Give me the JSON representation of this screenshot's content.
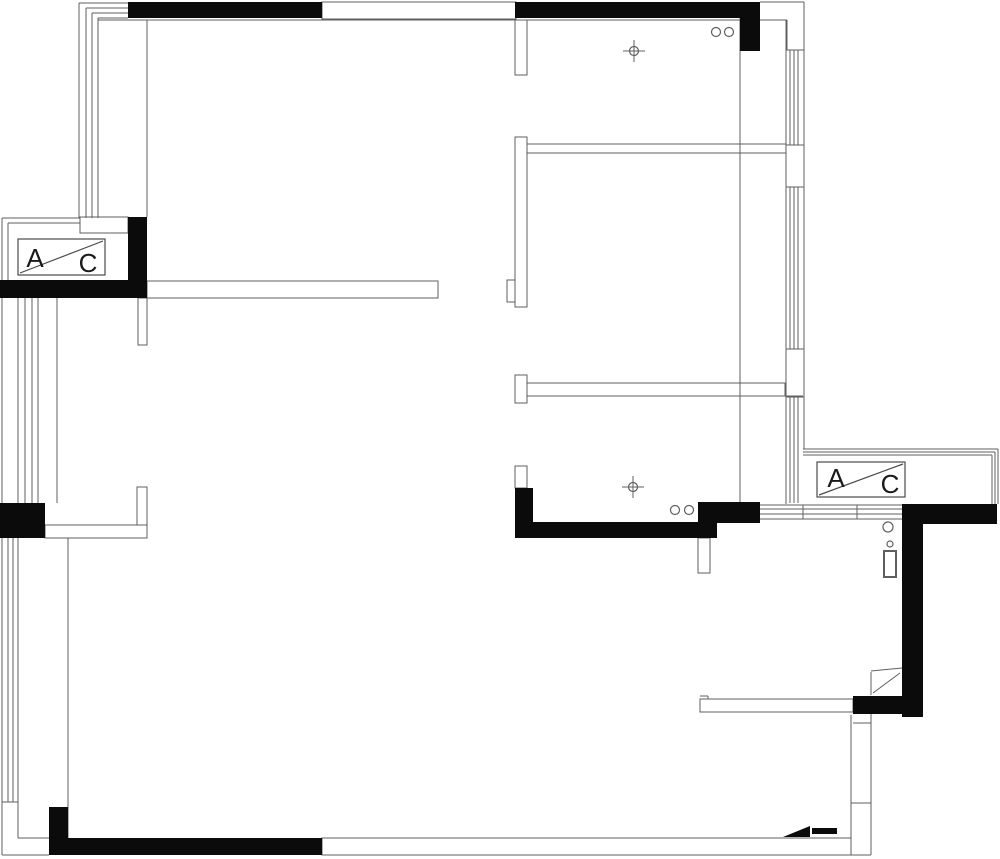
{
  "canvas": {
    "width": 1000,
    "height": 859,
    "background": "#ffffff",
    "line_color": "#5f5f5f",
    "wall_fill": "#0b0b0b",
    "text_color": "#1a1a1a"
  },
  "ac_labels": {
    "left": {
      "a": "A",
      "c": "C"
    },
    "right": {
      "a": "A",
      "c": "C"
    }
  },
  "plan": {
    "outline_rects": [
      {
        "n": "top-window-band",
        "x": 322,
        "y": 2,
        "w": 194,
        "h": 17
      },
      {
        "n": "wall-topleft-room-bottom",
        "x": 147,
        "y": 281,
        "w": 291,
        "h": 17
      },
      {
        "n": "wall-stub-below-topleft-room",
        "x": 138,
        "y": 298,
        "w": 9,
        "h": 47
      },
      {
        "n": "left-step-under-window",
        "x": 80,
        "y": 217,
        "w": 48,
        "h": 16
      },
      {
        "n": "wall-stub-middle-top",
        "x": 515,
        "y": 20,
        "w": 12,
        "h": 55
      },
      {
        "n": "wall-middle-vertical",
        "x": 515,
        "y": 137,
        "w": 12,
        "h": 170
      },
      {
        "n": "wall-notch-middle",
        "x": 507,
        "y": 280,
        "w": 8,
        "h": 22
      },
      {
        "n": "wall-middle-tee-stub",
        "x": 515,
        "y": 375,
        "w": 12,
        "h": 28
      },
      {
        "n": "wall-band-midroom-bottom",
        "x": 527,
        "y": 383,
        "w": 258,
        "h": 13
      },
      {
        "n": "wall-stub-above-kitchen-column",
        "x": 515,
        "y": 466,
        "w": 12,
        "h": 22
      },
      {
        "n": "wall-band-topright-room-bottom",
        "x": 527,
        "y": 144,
        "w": 259,
        "h": 9
      },
      {
        "n": "wall-stub-below-kitchen-bar",
        "x": 698,
        "y": 538,
        "w": 12,
        "h": 35
      },
      {
        "n": "hallway-wall",
        "x": 700,
        "y": 699,
        "w": 153,
        "h": 13
      },
      {
        "n": "bottom-wall-white",
        "x": 322,
        "y": 838,
        "w": 529,
        "h": 17
      },
      {
        "n": "left-ell-wall-vertical",
        "x": 137,
        "y": 487,
        "w": 10,
        "h": 38
      },
      {
        "n": "left-ell-wall-horizontal",
        "x": 45,
        "y": 525,
        "w": 102,
        "h": 13
      },
      {
        "n": "water-heater-body",
        "x": 884,
        "y": 551,
        "w": 12,
        "h": 26,
        "sw": 2
      }
    ],
    "lines": [
      {
        "n": "corner-nest-h1",
        "x1": 79,
        "y1": 3,
        "x2": 128,
        "y2": 3
      },
      {
        "n": "corner-nest-h2",
        "x1": 86,
        "y1": 8,
        "x2": 128,
        "y2": 8
      },
      {
        "n": "corner-nest-h3",
        "x1": 92,
        "y1": 13,
        "x2": 128,
        "y2": 13
      },
      {
        "n": "corner-nest-h4",
        "x1": 98,
        "y1": 18,
        "x2": 128,
        "y2": 18
      },
      {
        "n": "left-window-v1",
        "x1": 79,
        "y1": 3,
        "x2": 79,
        "y2": 218
      },
      {
        "n": "left-window-v2",
        "x1": 86,
        "y1": 8,
        "x2": 86,
        "y2": 218
      },
      {
        "n": "left-window-v3",
        "x1": 92,
        "y1": 13,
        "x2": 92,
        "y2": 218
      },
      {
        "n": "left-window-v4",
        "x1": 98,
        "y1": 18,
        "x2": 98,
        "y2": 218
      },
      {
        "n": "topleft-room-inner-top",
        "x1": 98,
        "y1": 20,
        "x2": 515,
        "y2": 20
      },
      {
        "n": "topleft-room-left-wall",
        "x1": 147,
        "y1": 20,
        "x2": 147,
        "y2": 217
      },
      {
        "n": "topright-room-inner-top",
        "x1": 527,
        "y1": 20,
        "x2": 740,
        "y2": 20
      },
      {
        "n": "topright-outer-top",
        "x1": 760,
        "y1": 2,
        "x2": 804,
        "y2": 2
      },
      {
        "n": "right-outer-edge",
        "x1": 804,
        "y1": 2,
        "x2": 804,
        "y2": 449
      },
      {
        "n": "topright-inner-ledge",
        "x1": 760,
        "y1": 20,
        "x2": 787,
        "y2": 20
      },
      {
        "n": "topright-inner-ledge-v",
        "x1": 787,
        "y1": 20,
        "x2": 787,
        "y2": 50
      },
      {
        "n": "right-wall-inner-edge",
        "x1": 786,
        "y1": 20,
        "x2": 786,
        "y2": 504
      },
      {
        "n": "right-window1-p1",
        "x1": 790,
        "y1": 50,
        "x2": 790,
        "y2": 145
      },
      {
        "n": "right-window1-p2",
        "x1": 794,
        "y1": 50,
        "x2": 794,
        "y2": 145
      },
      {
        "n": "right-window1-p3",
        "x1": 798,
        "y1": 50,
        "x2": 798,
        "y2": 145
      },
      {
        "n": "right-window1-top-tick",
        "x1": 786,
        "y1": 50,
        "x2": 804,
        "y2": 50
      },
      {
        "n": "right-window1-bottom-tick",
        "x1": 786,
        "y1": 145,
        "x2": 804,
        "y2": 145
      },
      {
        "n": "right-window2-p1",
        "x1": 790,
        "y1": 187,
        "x2": 790,
        "y2": 349
      },
      {
        "n": "right-window2-p2",
        "x1": 794,
        "y1": 187,
        "x2": 794,
        "y2": 349
      },
      {
        "n": "right-window2-p3",
        "x1": 798,
        "y1": 187,
        "x2": 798,
        "y2": 349
      },
      {
        "n": "right-window2-top-tick",
        "x1": 786,
        "y1": 187,
        "x2": 804,
        "y2": 187
      },
      {
        "n": "right-window2-bottom-tick",
        "x1": 786,
        "y1": 349,
        "x2": 804,
        "y2": 349
      },
      {
        "n": "right-window3-p1",
        "x1": 790,
        "y1": 397,
        "x2": 790,
        "y2": 503
      },
      {
        "n": "right-window3-p2",
        "x1": 794,
        "y1": 397,
        "x2": 794,
        "y2": 503
      },
      {
        "n": "right-window3-p3",
        "x1": 798,
        "y1": 397,
        "x2": 798,
        "y2": 503
      },
      {
        "n": "right-window3-top-tick",
        "x1": 786,
        "y1": 397,
        "x2": 804,
        "y2": 397
      },
      {
        "n": "interior-wall-x740",
        "x1": 740,
        "y1": 18,
        "x2": 740,
        "y2": 503
      },
      {
        "n": "midroom-band-ext",
        "x1": 785,
        "y1": 396,
        "x2": 803,
        "y2": 396
      },
      {
        "n": "left-platform-top1",
        "x1": 2,
        "y1": 218,
        "x2": 80,
        "y2": 218
      },
      {
        "n": "left-platform-top2",
        "x1": 8,
        "y1": 223,
        "x2": 80,
        "y2": 223
      },
      {
        "n": "left-outer-edge",
        "x1": 2,
        "y1": 218,
        "x2": 2,
        "y2": 855
      },
      {
        "n": "left-platform-inner-edge",
        "x1": 8,
        "y1": 223,
        "x2": 8,
        "y2": 280
      },
      {
        "n": "left-window-mid-1",
        "x1": 18,
        "y1": 298,
        "x2": 18,
        "y2": 503
      },
      {
        "n": "left-window-mid-2",
        "x1": 25,
        "y1": 298,
        "x2": 25,
        "y2": 503
      },
      {
        "n": "left-window-mid-3",
        "x1": 32,
        "y1": 298,
        "x2": 32,
        "y2": 503
      },
      {
        "n": "left-window-mid-4",
        "x1": 38,
        "y1": 298,
        "x2": 38,
        "y2": 503
      },
      {
        "n": "left-window-mid-inner",
        "x1": 57,
        "y1": 298,
        "x2": 57,
        "y2": 503
      },
      {
        "n": "left-window-low-1",
        "x1": 8,
        "y1": 538,
        "x2": 8,
        "y2": 802
      },
      {
        "n": "left-window-low-2",
        "x1": 13,
        "y1": 538,
        "x2": 13,
        "y2": 802
      },
      {
        "n": "left-window-low-3",
        "x1": 18,
        "y1": 538,
        "x2": 18,
        "y2": 802
      },
      {
        "n": "left-window-low-end-tick",
        "x1": 2,
        "y1": 802,
        "x2": 18,
        "y2": 802
      },
      {
        "n": "left-low-corner-v",
        "x1": 18,
        "y1": 802,
        "x2": 18,
        "y2": 838
      },
      {
        "n": "left-low-corner-h",
        "x1": 18,
        "y1": 838,
        "x2": 49,
        "y2": 838
      },
      {
        "n": "bottomleft-outer",
        "x1": 2,
        "y1": 855,
        "x2": 49,
        "y2": 855
      },
      {
        "n": "livingroom-left-wall",
        "x1": 68,
        "y1": 538,
        "x2": 68,
        "y2": 838
      },
      {
        "n": "hall-right-wall-inner",
        "x1": 851,
        "y1": 715,
        "x2": 851,
        "y2": 838
      },
      {
        "n": "hall-right-wall-outer",
        "x1": 871,
        "y1": 714,
        "x2": 871,
        "y2": 855
      },
      {
        "n": "hall-right-wall-tick1",
        "x1": 851,
        "y1": 803,
        "x2": 871,
        "y2": 803
      },
      {
        "n": "hall-right-wall-tick2",
        "x1": 853,
        "y1": 723,
        "x2": 871,
        "y2": 723
      },
      {
        "n": "bottomright-outer",
        "x1": 851,
        "y1": 855,
        "x2": 871,
        "y2": 855
      },
      {
        "n": "hallway-wall-notch-h",
        "x1": 700,
        "y1": 696,
        "x2": 708,
        "y2": 696
      },
      {
        "n": "hallway-wall-notch-v",
        "x1": 708,
        "y1": 696,
        "x2": 708,
        "y2": 699
      },
      {
        "n": "door-leaf-top",
        "x1": 871,
        "y1": 671,
        "x2": 902,
        "y2": 668
      },
      {
        "n": "door-leaf-side",
        "x1": 871,
        "y1": 672,
        "x2": 871,
        "y2": 695
      },
      {
        "n": "door-swing",
        "x1": 873,
        "y1": 693,
        "x2": 900,
        "y2": 673
      },
      {
        "n": "south-window-band-1",
        "x1": 760,
        "y1": 505,
        "x2": 902,
        "y2": 505
      },
      {
        "n": "south-window-band-2",
        "x1": 760,
        "y1": 509,
        "x2": 902,
        "y2": 509
      },
      {
        "n": "south-window-band-3",
        "x1": 760,
        "y1": 514,
        "x2": 902,
        "y2": 514
      },
      {
        "n": "south-window-band-4",
        "x1": 760,
        "y1": 519,
        "x2": 902,
        "y2": 519
      },
      {
        "n": "south-window-tick1",
        "x1": 803,
        "y1": 505,
        "x2": 803,
        "y2": 519
      },
      {
        "n": "south-window-tick2",
        "x1": 857,
        "y1": 505,
        "x2": 857,
        "y2": 519
      },
      {
        "n": "right-platform-top-1",
        "x1": 803,
        "y1": 449,
        "x2": 998,
        "y2": 449
      },
      {
        "n": "right-platform-top-2",
        "x1": 803,
        "y1": 452,
        "x2": 995,
        "y2": 452
      },
      {
        "n": "right-platform-top-3",
        "x1": 803,
        "y1": 455,
        "x2": 992,
        "y2": 455
      },
      {
        "n": "right-platform-edge-1",
        "x1": 998,
        "y1": 449,
        "x2": 998,
        "y2": 504
      },
      {
        "n": "right-platform-edge-2",
        "x1": 995,
        "y1": 452,
        "x2": 995,
        "y2": 504
      },
      {
        "n": "right-platform-edge-3",
        "x1": 992,
        "y1": 455,
        "x2": 992,
        "y2": 504
      }
    ],
    "circles": [
      {
        "n": "pipe-circle",
        "cx": 716,
        "cy": 32,
        "r": 4.5
      },
      {
        "n": "pipe-circle",
        "cx": 729,
        "cy": 32,
        "r": 4.5
      },
      {
        "n": "pipe-circle",
        "cx": 675,
        "cy": 510,
        "r": 4.5
      },
      {
        "n": "pipe-circle",
        "cx": 689,
        "cy": 510,
        "r": 4.5
      },
      {
        "n": "drain-circle",
        "cx": 888,
        "cy": 527,
        "r": 5
      },
      {
        "n": "water-heater-knob",
        "cx": 890,
        "cy": 544,
        "r": 3
      }
    ],
    "black_rects": [
      {
        "n": "column-top-wall-left",
        "x": 128,
        "y": 2,
        "w": 194,
        "h": 16
      },
      {
        "n": "column-top-wall-right",
        "x": 515,
        "y": 2,
        "w": 245,
        "h": 16
      },
      {
        "n": "column-topright-corner",
        "x": 740,
        "y": 18,
        "w": 20,
        "h": 33
      },
      {
        "n": "column-left-ac",
        "x": 128,
        "y": 217,
        "w": 19,
        "h": 81
      },
      {
        "n": "wall-left-ac-bottom",
        "x": 0,
        "y": 280,
        "w": 147,
        "h": 18
      },
      {
        "n": "column-left-mid",
        "x": 0,
        "y": 503,
        "w": 45,
        "h": 35
      },
      {
        "n": "column-kitchen",
        "x": 515,
        "y": 488,
        "w": 18,
        "h": 35
      },
      {
        "n": "wall-kitchen-bar",
        "x": 515,
        "y": 522,
        "w": 202,
        "h": 16
      },
      {
        "n": "wall-kitchen-bar-upper",
        "x": 698,
        "y": 502,
        "w": 62,
        "h": 21
      },
      {
        "n": "wall-right-ell-horizontal",
        "x": 905,
        "y": 504,
        "w": 92,
        "h": 20
      },
      {
        "n": "wall-right-ell-vertical",
        "x": 902,
        "y": 504,
        "w": 21,
        "h": 213
      },
      {
        "n": "wall-right-bottom-bar",
        "x": 853,
        "y": 696,
        "w": 69,
        "h": 18
      },
      {
        "n": "column-bottomleft",
        "x": 49,
        "y": 807,
        "w": 19,
        "h": 33
      },
      {
        "n": "wall-bottom-black",
        "x": 49,
        "y": 838,
        "w": 273,
        "h": 17
      },
      {
        "n": "threshold-bar",
        "x": 812,
        "y": 828,
        "w": 25,
        "h": 6
      }
    ],
    "polygons": [
      {
        "n": "threshold-triangle",
        "points": "783,837 810,837 810,826"
      }
    ],
    "crosshairs": [
      {
        "n": "ceiling-fixture-crosshair",
        "x": 634,
        "y": 51
      },
      {
        "n": "ceiling-fixture-crosshair",
        "x": 633,
        "y": 487
      }
    ]
  }
}
